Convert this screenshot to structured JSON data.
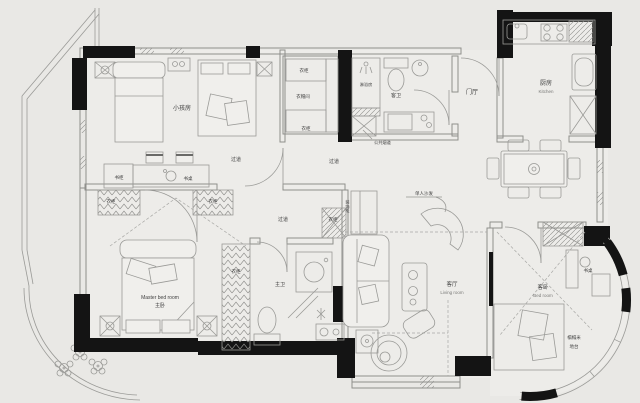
{
  "title": "apartment-floor-plan",
  "colors": {
    "background": "#e9e8e5",
    "floor": "#edecE9",
    "wall_black": "#141414",
    "line_gray": "#8f8f8c",
    "text": "#3f3f3f"
  },
  "plan": {
    "rooms": {
      "kids_bedroom": "小孩房",
      "hallway": "过道",
      "cloakroom": "衣帽间",
      "shower_room": "淋浴房",
      "guest_bathroom": "客卫",
      "foyer": "门厅",
      "kitchen": "厨房",
      "kitchen_en": "Kitchen",
      "living_room": "客厅",
      "living_room_en": "Living room",
      "master_bedroom_en": "Master bed room",
      "master_bedroom": "主卧",
      "master_bathroom": "主卫",
      "guest_bedroom": "客卧",
      "guest_bedroom_en": "Bed room"
    },
    "furniture": {
      "wardrobe": "衣柜",
      "desk": "书桌",
      "bookcase": "书柜",
      "guest_desk": "书桌",
      "single_sofa": "单人沙发",
      "deco_cabinet": "装饰柜",
      "tatami": "榻榻米",
      "platform": "地台",
      "flue": "公共烟道"
    }
  }
}
